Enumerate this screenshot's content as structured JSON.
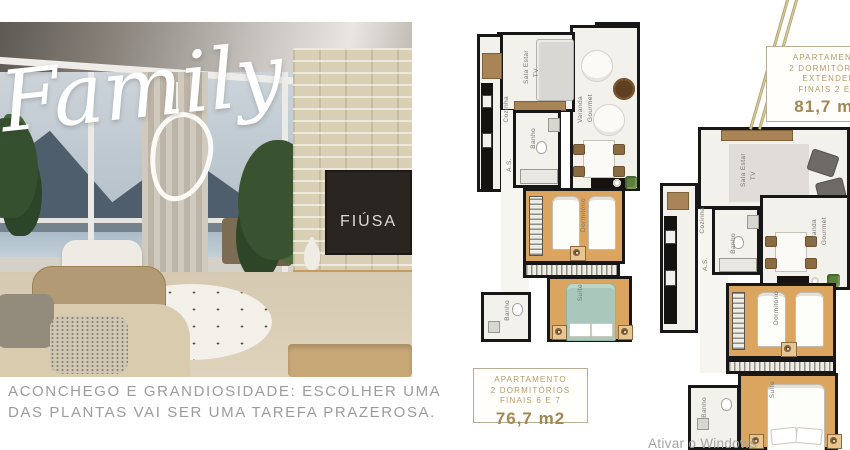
{
  "hero": {
    "script_title": "Family",
    "tv_label": "FIÚSA",
    "caption_line1": "ACONCHEGO E GRANDIOSIDADE: ESCOLHER UMA",
    "caption_line2": "DAS PLANTAS VAI SER UMA TAREFA PRAZEROSA."
  },
  "rooms": {
    "sala_1": "Sala Estar",
    "sala_2": "TV",
    "cozinha": "Cozinha",
    "area_servico": "A.S.",
    "banho": "Banho",
    "varanda_1": "Varanda",
    "varanda_2": "Gourmet",
    "dormitorio": "Dormitório",
    "suite": "Suíte"
  },
  "plan_small_label": {
    "line1": "APARTAMENTO",
    "line2": "2 DORMITÓRIOS",
    "line3": "FINAIS 6 E 7",
    "area": "76,7 m2"
  },
  "plan_large_label": {
    "line1": "APARTAMENTO",
    "line2": "2 DORMITÓRIOS",
    "line3": "EXTENDED",
    "line4": "FINAIS 2 E 3",
    "area": "81,7 m2"
  },
  "watermark": "Ativar o Windows",
  "colors": {
    "accent_gold": "#b49a6a",
    "plan_wood": "#dca55f",
    "suite_bed_teal": "#a9c8bb",
    "wall_black": "#171717",
    "caption_gray": "#9c9c9c"
  }
}
